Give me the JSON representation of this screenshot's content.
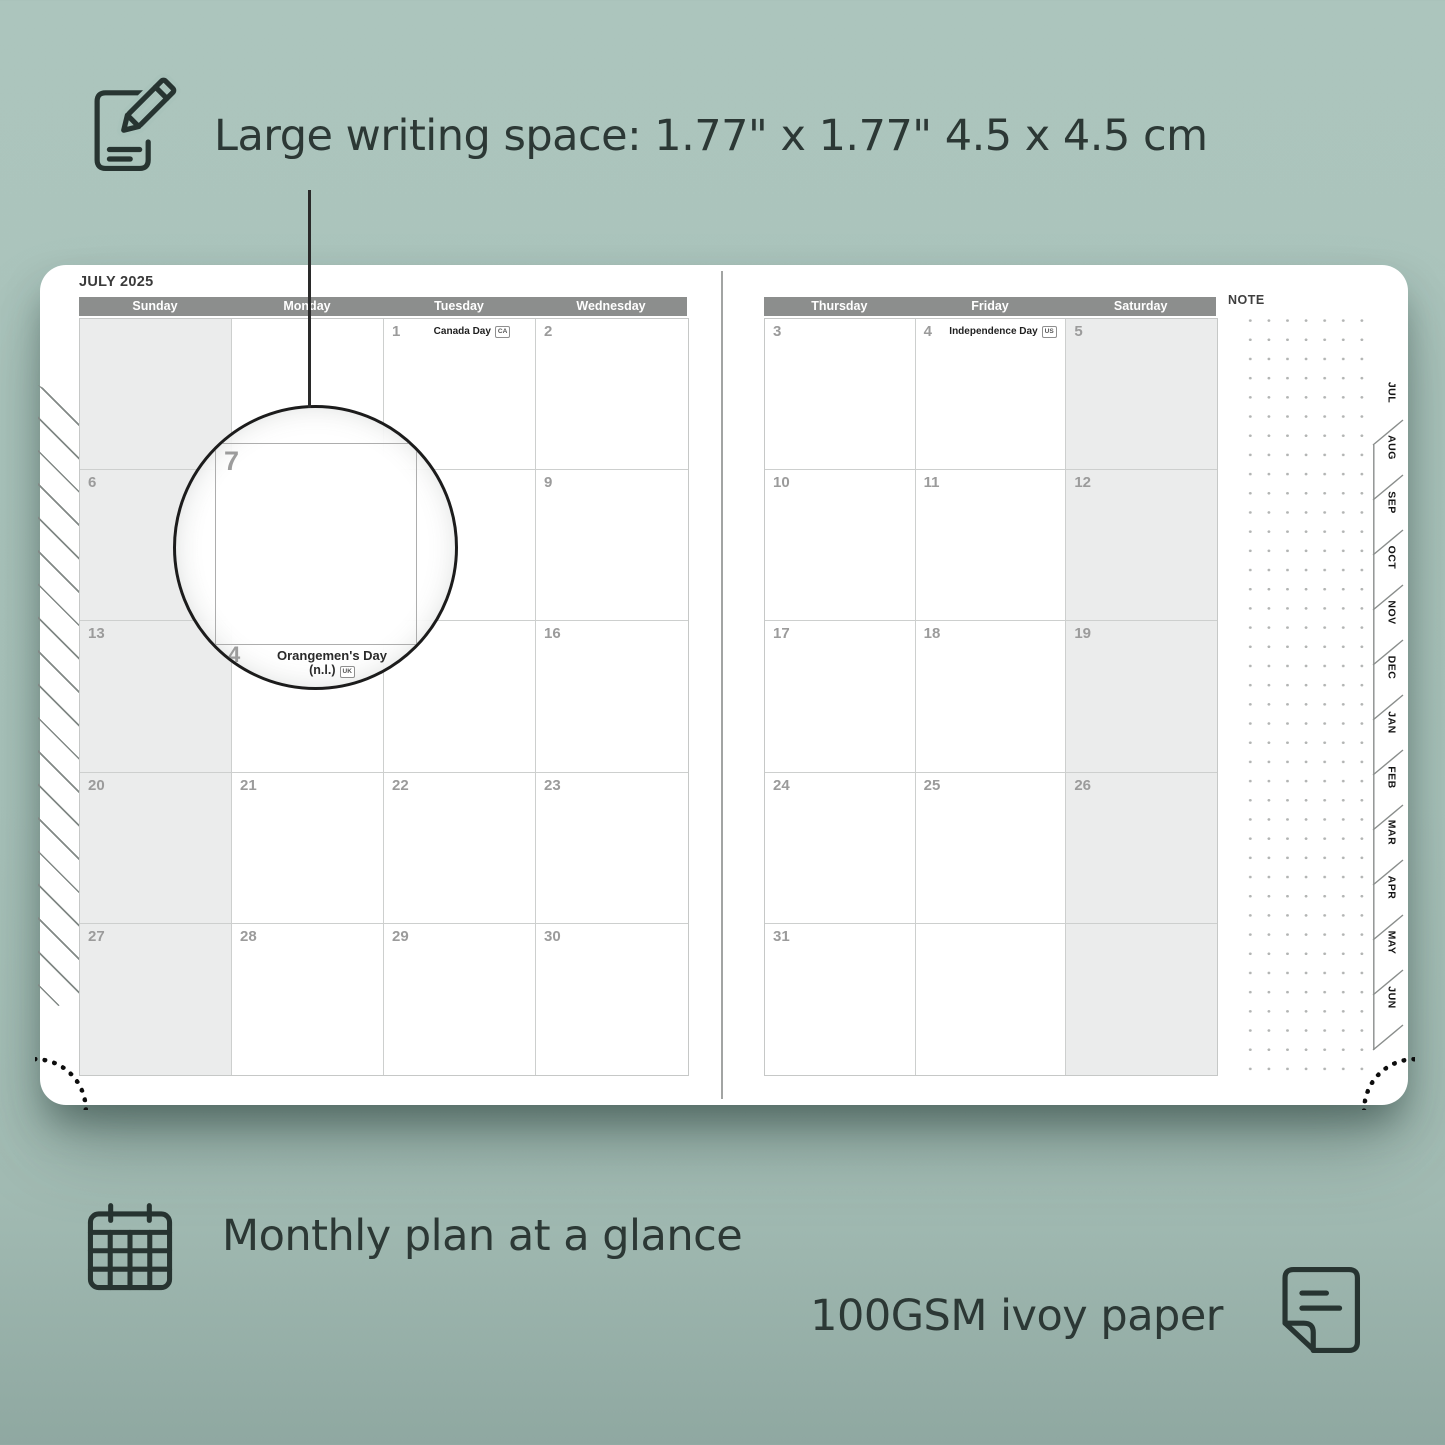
{
  "annotations": {
    "writing_space": "Large writing space: 1.77\" x 1.77\"  4.5 x 4.5 cm",
    "monthly_plan": "Monthly plan at a glance",
    "paper": "100GSM ivoy paper"
  },
  "planner": {
    "month_title": "JULY 2025",
    "note_label": "NOTE",
    "left_page": {
      "day_headers": [
        "Sunday",
        "Monday",
        "Tuesday",
        "Wednesday"
      ],
      "weeks": [
        [
          {
            "date": "",
            "shaded": true
          },
          {
            "date": ""
          },
          {
            "date": "1",
            "holiday": "Canada Day",
            "badge": "CA"
          },
          {
            "date": "2"
          }
        ],
        [
          {
            "date": "6",
            "shaded": true
          },
          {
            "date": "7",
            "hidden": true
          },
          {
            "date": "8",
            "hidden": true
          },
          {
            "date": "9"
          }
        ],
        [
          {
            "date": "13",
            "shaded": true
          },
          {
            "date": "14",
            "holiday": "Orangemen's Day (n.l.)",
            "badge": "UK",
            "hidden": true
          },
          {
            "date": "15",
            "hidden": true
          },
          {
            "date": "16"
          }
        ],
        [
          {
            "date": "20",
            "shaded": true
          },
          {
            "date": "21"
          },
          {
            "date": "22"
          },
          {
            "date": "23"
          }
        ],
        [
          {
            "date": "27",
            "shaded": true
          },
          {
            "date": "28"
          },
          {
            "date": "29"
          },
          {
            "date": "30"
          }
        ]
      ]
    },
    "right_page": {
      "day_headers": [
        "Thursday",
        "Friday",
        "Saturday"
      ],
      "weeks": [
        [
          {
            "date": "3"
          },
          {
            "date": "4",
            "holiday": "Independence Day",
            "badge": "US"
          },
          {
            "date": "5",
            "shaded": true
          }
        ],
        [
          {
            "date": "10"
          },
          {
            "date": "11"
          },
          {
            "date": "12",
            "shaded": true
          }
        ],
        [
          {
            "date": "17"
          },
          {
            "date": "18"
          },
          {
            "date": "19",
            "shaded": true
          }
        ],
        [
          {
            "date": "24"
          },
          {
            "date": "25"
          },
          {
            "date": "26",
            "shaded": true
          }
        ],
        [
          {
            "date": "31"
          },
          {
            "date": ""
          },
          {
            "date": "",
            "shaded": true
          }
        ]
      ]
    },
    "month_tabs": [
      "JUL",
      "AUG",
      "SEP",
      "OCT",
      "NOV",
      "DEC",
      "JAN",
      "FEB",
      "MAR",
      "APR",
      "MAY",
      "JUN"
    ]
  },
  "lens": {
    "magnified_date": "7",
    "under_date": "4",
    "holiday_line1": "Orangemen's Day",
    "holiday_line2": "(n.l.)",
    "badge": "UK"
  },
  "colors": {
    "background": "#a9c3bb",
    "text_dark": "#2c3835",
    "header_bar": "#8c8e8d",
    "weekend_fill": "#ebecec",
    "grid_line": "#cdcfce",
    "date_number": "#9b9b9b"
  }
}
